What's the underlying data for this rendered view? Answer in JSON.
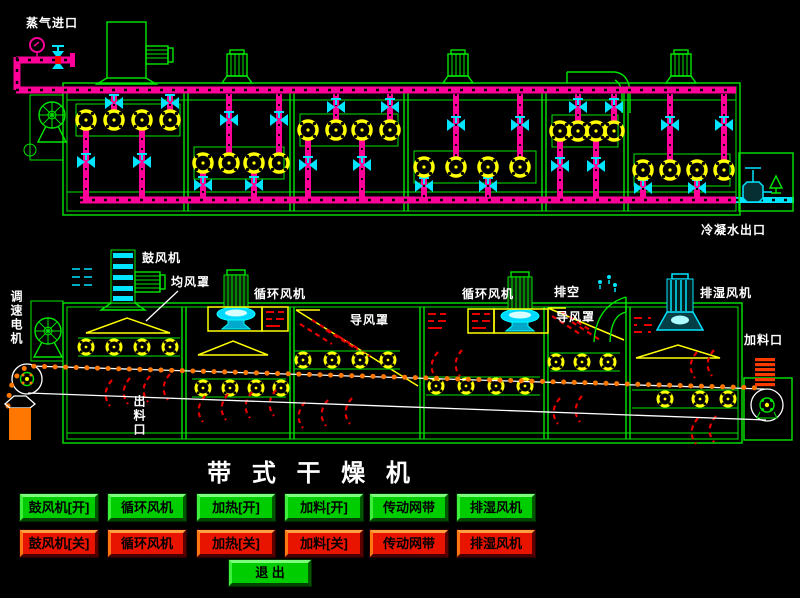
{
  "title": "带 式 干 燥 机",
  "top_diagram": {
    "steam_inlet_label": "蒸气进口",
    "condensate_outlet_label": "冷凝水出口"
  },
  "middle_diagram": {
    "blower_label": "鼓风机",
    "air_distributor_label": "均风罩",
    "speed_motor_label": "调速电机",
    "circulation_fan_label_1": "循环风机",
    "circulation_fan_label_2": "循环风机",
    "air_guide_label_1": "导风罩",
    "air_guide_label_2": "导风罩",
    "vent_label": "排空",
    "dehumidifier_fan_label": "排湿风机",
    "feed_inlet_label": "加料口",
    "discharge_outlet_label": "出料口"
  },
  "controls": {
    "on_buttons": [
      "鼓风机[开]",
      "循环风机[开]",
      "加热[开]",
      "加料[开]",
      "传动网带[开]",
      "排湿风机[开]"
    ],
    "off_buttons": [
      "鼓风机[关]",
      "循环风机[关]",
      "加热[关]",
      "加料[关]",
      "传动网带[关]",
      "排湿风机[关]"
    ],
    "exit_label": "退 出"
  },
  "colors": {
    "background": "#000000",
    "frame_green": "#00e600",
    "pipe_magenta": "#ff0099",
    "valve_cyan": "#00e5ff",
    "coil_yellow": "#ffff00",
    "heat_red": "#e60000",
    "belt_orange": "#ff7700",
    "button_on_green": "#00cd00",
    "button_off_red": "#e81400",
    "text_white": "#ffffff"
  }
}
